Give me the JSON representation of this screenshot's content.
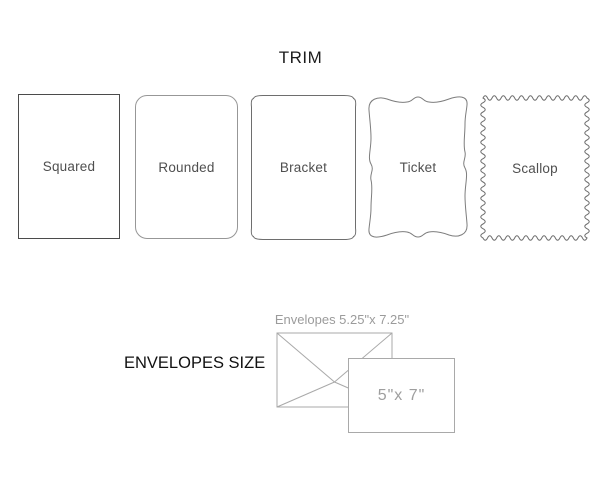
{
  "trim": {
    "title": "TRIM",
    "shapes": [
      {
        "label": "Squared"
      },
      {
        "label": "Rounded"
      },
      {
        "label": "Bracket"
      },
      {
        "label": "Ticket"
      },
      {
        "label": "Scallop"
      }
    ]
  },
  "envelopes": {
    "heading": "ENVELOPES SIZE",
    "envelope_caption": "Envelopes 5.25\"x 7.25\"",
    "card_label": "5\"x 7\""
  },
  "colors": {
    "title_text": "#1c1c1c",
    "shape_label_text": "#4f4f4f",
    "squared_outline": "#4b4b4b",
    "rounded_outline": "#979797",
    "bracket_outline": "#6e6e6e",
    "ticket_outline": "#7d7d7d",
    "scallop_outline": "#6e6e6e",
    "envelope_outline": "#a9a9a9",
    "caption_text": "#9b9b9b",
    "card_size_text": "#9e9e9e",
    "background": "#ffffff"
  }
}
